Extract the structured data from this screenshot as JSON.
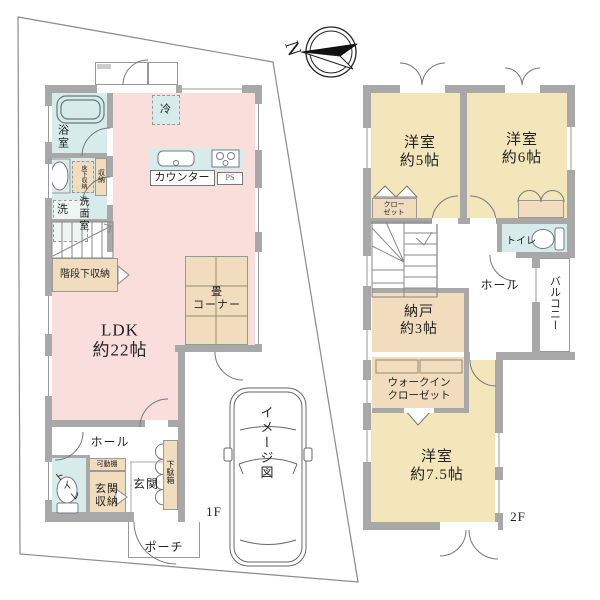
{
  "compass": {
    "north_label": "N"
  },
  "image_caption": "イメージ図",
  "floor1": {
    "label": "1F",
    "bathroom": "浴室",
    "washroom": "洗面室",
    "laundry": "洗",
    "underfloor_storage": "床下収納",
    "storage": "収納",
    "fridge": "冷",
    "counter": "カウンター",
    "ps": "PS",
    "under_stairs_storage": "階段下収納",
    "tatami_corner": "畳\nコーナー",
    "ldk": "LDK\n約22帖",
    "hall": "ホール",
    "toilet": "トイレ",
    "movable_shelf": "可動棚",
    "entrance_storage": "玄関\n収納",
    "entrance": "玄関",
    "shoe_cabinet": "下駄箱",
    "porch": "ポーチ"
  },
  "floor2": {
    "label": "2F",
    "bedroom_5": "洋室\n約5帖",
    "bedroom_6": "洋室\n約6帖",
    "closet": "クロー\nゼット",
    "toilet": "トイレ",
    "hall": "ホール",
    "balcony": "バルコニー",
    "storeroom": "納戸\n約3帖",
    "walk_in_closet": "ウォークイン\nクローゼット",
    "bedroom_7_5": "洋室\n約7.5帖"
  },
  "colors": {
    "wall": "#a8a8a8",
    "pink": "#f9dedb",
    "yellow": "#f4e6bb",
    "beige": "#f1dcbd",
    "green": "#e7efd8",
    "cyan": "#d7ecea",
    "line": "#777777"
  }
}
